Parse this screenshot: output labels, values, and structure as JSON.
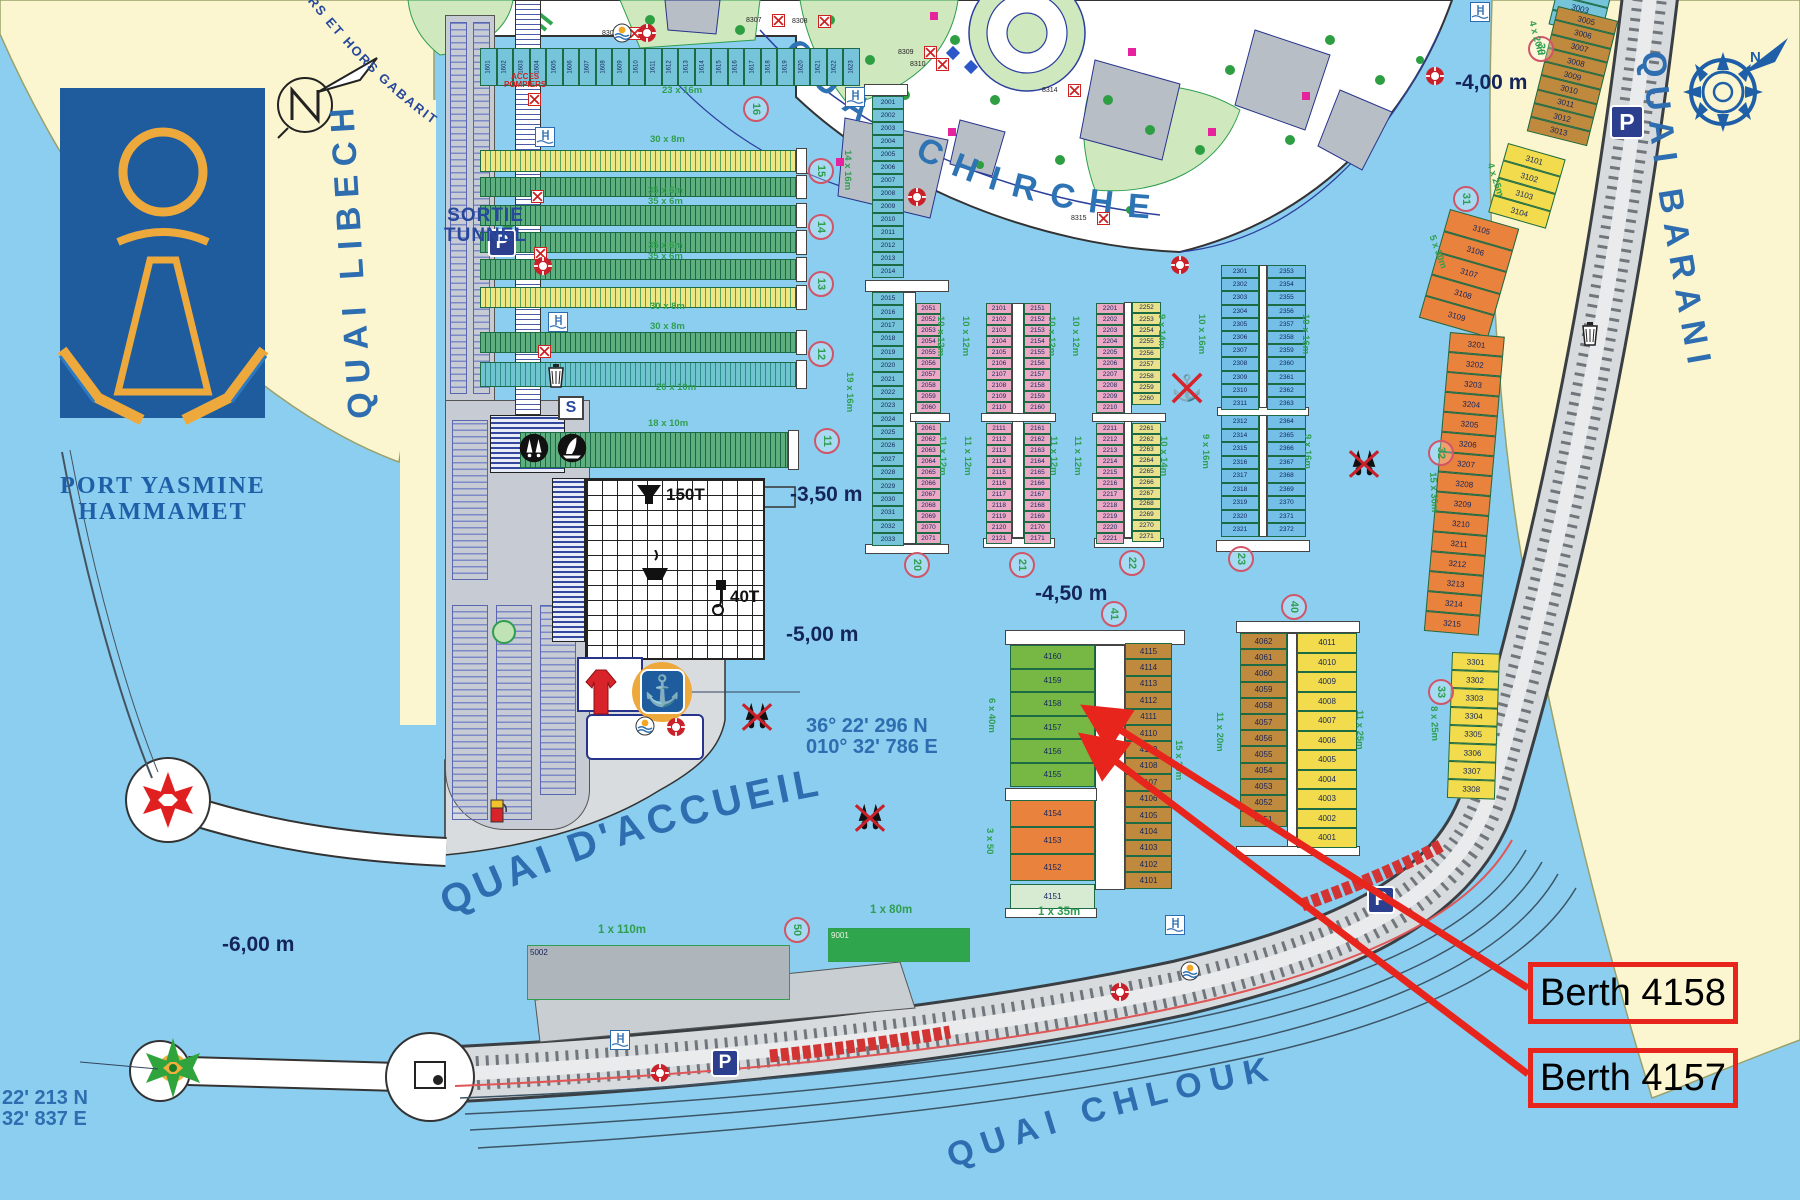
{
  "logo": {
    "title_line1": "PORT YASMINE",
    "title_line2": "HAMMAMET"
  },
  "curved_labels": {
    "top_gabarit": "URS ET HORS GABARIT",
    "quai_libeche": "QUAI LIBECHE",
    "quai_chirche": "QUAI CHIRCHE",
    "quai_barani": "QUAI BARANI",
    "quai_daccueil": "QUAI D'ACCUEIL",
    "quai_chlouk": "QUAI CHLOUK"
  },
  "signs": {
    "sortie_line1": "SORTIE",
    "sortie_line2": "TUNNEL",
    "acces_line1": "ACCES",
    "acces_line2": "POMPIERS",
    "s_sign": "S",
    "lift": "150T",
    "crane": "40T",
    "parking": "P",
    "compass_n": "N"
  },
  "coordinates": {
    "main_line1": "36° 22' 296 N",
    "main_line2": "010° 32' 786 E",
    "west_line1": "22' 213 N",
    "west_line2": "32' 837 E"
  },
  "depth_labels": [
    {
      "text": "-4,00 m",
      "x": 1455,
      "y": 72
    },
    {
      "text": "-3,50 m",
      "x": 790,
      "y": 484
    },
    {
      "text": "-4,50 m",
      "x": 1035,
      "y": 583
    },
    {
      "text": "-5,00 m",
      "x": 786,
      "y": 624
    },
    {
      "text": "-6,00 m",
      "x": 222,
      "y": 934
    }
  ],
  "annotation": {
    "accent": "#E8251C",
    "items": [
      {
        "label": "Berth 4158",
        "box": {
          "x": 1528,
          "y": 962,
          "w": 210,
          "h": 62
        },
        "tip": {
          "x": 1080,
          "y": 706
        }
      },
      {
        "label": "Berth 4157",
        "box": {
          "x": 1528,
          "y": 1048,
          "w": 210,
          "h": 60
        },
        "tip": {
          "x": 1077,
          "y": 735
        }
      }
    ]
  },
  "pontoon_circles": [
    {
      "n": "16",
      "x": 743,
      "y": 96
    },
    {
      "n": "15",
      "x": 808,
      "y": 158
    },
    {
      "n": "14",
      "x": 808,
      "y": 214
    },
    {
      "n": "13",
      "x": 808,
      "y": 271
    },
    {
      "n": "12",
      "x": 808,
      "y": 341
    },
    {
      "n": "11",
      "x": 814,
      "y": 428
    },
    {
      "n": "20",
      "x": 904,
      "y": 552
    },
    {
      "n": "21",
      "x": 1009,
      "y": 552
    },
    {
      "n": "22",
      "x": 1119,
      "y": 550
    },
    {
      "n": "23",
      "x": 1228,
      "y": 546
    },
    {
      "n": "40",
      "x": 1281,
      "y": 594
    },
    {
      "n": "41",
      "x": 1101,
      "y": 601
    },
    {
      "n": "30",
      "x": 1528,
      "y": 36
    },
    {
      "n": "31",
      "x": 1453,
      "y": 186
    },
    {
      "n": "32",
      "x": 1428,
      "y": 440
    },
    {
      "n": "33",
      "x": 1428,
      "y": 679
    },
    {
      "n": "50",
      "x": 784,
      "y": 917
    }
  ],
  "columns": [
    {
      "name": "col-2001",
      "x": 872,
      "y": 96,
      "w": 32,
      "cell_h": 13,
      "count": 14,
      "start": 2001,
      "step": 1,
      "color": "c-teal"
    },
    {
      "name": "col-2015",
      "x": 872,
      "y": 292,
      "w": 32,
      "cell_h": 13.4,
      "count": 19,
      "start": 2015,
      "step": 1,
      "color": "c-teal"
    },
    {
      "name": "col-2051",
      "x": 916,
      "y": 303,
      "w": 25,
      "cell_h": 11,
      "count": 10,
      "start": 2051,
      "step": 1,
      "color": "c-pink"
    },
    {
      "name": "col-2061",
      "x": 916,
      "y": 423,
      "w": 25,
      "cell_h": 11,
      "count": 11,
      "start": 2061,
      "step": 1,
      "color": "c-pink"
    },
    {
      "name": "col-2101",
      "x": 986,
      "y": 303,
      "w": 26,
      "cell_h": 11,
      "count": 10,
      "start": 2101,
      "step": 1,
      "color": "c-pink"
    },
    {
      "name": "col-2111",
      "x": 986,
      "y": 423,
      "w": 26,
      "cell_h": 11,
      "count": 11,
      "start": 2111,
      "step": 1,
      "color": "c-pink"
    },
    {
      "name": "col-2151",
      "x": 1024,
      "y": 303,
      "w": 27,
      "cell_h": 11,
      "count": 10,
      "start": 2151,
      "step": 1,
      "color": "c-pink"
    },
    {
      "name": "col-2161",
      "x": 1024,
      "y": 423,
      "w": 27,
      "cell_h": 11,
      "count": 11,
      "start": 2161,
      "step": 1,
      "color": "c-pink"
    },
    {
      "name": "col-2201",
      "x": 1096,
      "y": 303,
      "w": 28,
      "cell_h": 11,
      "count": 10,
      "start": 2201,
      "step": 1,
      "color": "c-pink"
    },
    {
      "name": "col-2211",
      "x": 1096,
      "y": 423,
      "w": 28,
      "cell_h": 11,
      "count": 11,
      "start": 2211,
      "step": 1,
      "color": "c-pink"
    },
    {
      "name": "col-2252",
      "x": 1132,
      "y": 302,
      "w": 29,
      "cell_h": 11.4,
      "count": 9,
      "start": 2252,
      "step": 1,
      "color": "c-yel"
    },
    {
      "name": "col-2261",
      "x": 1132,
      "y": 423,
      "w": 29,
      "cell_h": 10.8,
      "count": 11,
      "start": 2261,
      "step": 1,
      "color": "c-yel"
    },
    {
      "name": "col-2301",
      "x": 1221,
      "y": 265,
      "w": 38,
      "cell_h": 13.2,
      "count": 11,
      "start": 2301,
      "step": 1,
      "color": "c-blue"
    },
    {
      "name": "col-2312",
      "x": 1221,
      "y": 415,
      "w": 38,
      "cell_h": 13.5,
      "count": 9,
      "nums": [
        2312,
        2314,
        2315,
        2316,
        2317,
        2318,
        2319,
        2320,
        2321
      ],
      "color": "c-blue"
    },
    {
      "name": "col-2353",
      "x": 1267,
      "y": 265,
      "w": 39,
      "cell_h": 13.2,
      "count": 11,
      "start": 2353,
      "step": 1,
      "color": "c-blue"
    },
    {
      "name": "col-2364",
      "x": 1267,
      "y": 415,
      "w": 39,
      "cell_h": 13.5,
      "count": 9,
      "start": 2364,
      "step": 1,
      "color": "c-blue"
    },
    {
      "name": "col-4160",
      "x": 1010,
      "y": 645,
      "w": 85,
      "cell_h": 23.6,
      "count": 6,
      "start": 4160,
      "step": -1,
      "color": "c-green"
    },
    {
      "name": "col-4154",
      "x": 1010,
      "y": 800,
      "w": 85,
      "cell_h": 27,
      "count": 3,
      "start": 4154,
      "step": -1,
      "color": "c-orange"
    },
    {
      "name": "col-4151",
      "x": 1010,
      "y": 884,
      "w": 85,
      "cell_h": 25,
      "count": 1,
      "start": 4151,
      "step": -1,
      "color": "c-lgreen"
    },
    {
      "name": "col-4115",
      "x": 1125,
      "y": 643,
      "w": 47,
      "cell_h": 16.4,
      "count": 15,
      "start": 4115,
      "step": -1,
      "color": "c-tan"
    },
    {
      "name": "col-4062",
      "x": 1240,
      "y": 633,
      "w": 47,
      "cell_h": 16.2,
      "count": 12,
      "start": 4062,
      "step": -1,
      "color": "c-tan"
    },
    {
      "name": "col-4011",
      "x": 1297,
      "y": 633,
      "w": 60,
      "cell_h": 19.5,
      "count": 11,
      "start": 4011,
      "step": -1,
      "color": "c-gold"
    },
    {
      "name": "col-3001",
      "x": 1563,
      "y": -34,
      "w": 54,
      "cell_h": 15,
      "count": 4,
      "start": 3001,
      "step": 1,
      "color": "c-teal",
      "rot": 14
    },
    {
      "name": "col-3005",
      "x": 1558,
      "y": 6,
      "w": 62,
      "cell_h": 14.3,
      "count": 9,
      "start": 3005,
      "step": 1,
      "color": "c-tan",
      "rot": 14
    },
    {
      "name": "col-3101",
      "x": 1508,
      "y": 143,
      "w": 60,
      "cell_h": 18,
      "count": 4,
      "start": 3101,
      "step": 1,
      "color": "c-gold",
      "rot": 16
    },
    {
      "name": "col-3105",
      "x": 1450,
      "y": 209,
      "w": 72,
      "cell_h": 22.5,
      "count": 5,
      "start": 3105,
      "step": 1,
      "color": "c-orange",
      "rot": 16
    },
    {
      "name": "col-3201",
      "x": 1450,
      "y": 332,
      "w": 55,
      "cell_h": 20,
      "count": 15,
      "start": 3201,
      "step": 1,
      "color": "c-orange",
      "rot": 5
    },
    {
      "name": "col-3301",
      "x": 1452,
      "y": 652,
      "w": 48,
      "cell_h": 18.2,
      "count": 8,
      "start": 3301,
      "step": 1,
      "color": "c-gold",
      "rot": 2
    }
  ],
  "row_cells": {
    "name": "row-1601",
    "x": 480,
    "y": 48,
    "w": 380,
    "h": 38,
    "count": 23,
    "start": 1601,
    "color": "c-teal"
  },
  "rows": [
    {
      "name": "row-p15-yellow",
      "x": 480,
      "y": 150,
      "w": 316,
      "h": 22,
      "style": "stripe-yel"
    },
    {
      "name": "row-p15-green",
      "x": 480,
      "y": 177,
      "w": 316,
      "h": 20,
      "style": "stripe-grn"
    },
    {
      "name": "row-p14-green-a",
      "x": 480,
      "y": 205,
      "w": 316,
      "h": 21,
      "style": "stripe-grn"
    },
    {
      "name": "row-p14-green-b",
      "x": 480,
      "y": 232,
      "w": 316,
      "h": 21,
      "style": "stripe-grn"
    },
    {
      "name": "row-p13-green",
      "x": 480,
      "y": 259,
      "w": 316,
      "h": 21,
      "style": "stripe-grn"
    },
    {
      "name": "row-p12-yellow",
      "x": 480,
      "y": 287,
      "w": 316,
      "h": 21,
      "style": "stripe-yel"
    },
    {
      "name": "row-p12-green",
      "x": 480,
      "y": 332,
      "w": 316,
      "h": 21,
      "style": "stripe-grn"
    },
    {
      "name": "row-p11-teal",
      "x": 480,
      "y": 362,
      "w": 316,
      "h": 25,
      "style": "stripe-teal"
    },
    {
      "name": "row-1801-strip",
      "x": 520,
      "y": 432,
      "w": 268,
      "h": 36,
      "style": "stripe-grn"
    }
  ],
  "dim_labels": [
    {
      "text": "23 x 16m",
      "x": 662,
      "y": 86,
      "rot": 0
    },
    {
      "text": "30 x 8m",
      "x": 650,
      "y": 135,
      "rot": 0
    },
    {
      "text": "35 x 6m",
      "x": 648,
      "y": 186,
      "rot": 0
    },
    {
      "text": "35 x 6m",
      "x": 648,
      "y": 197,
      "rot": 0
    },
    {
      "text": "35 x 6m",
      "x": 648,
      "y": 241,
      "rot": 0
    },
    {
      "text": "35 x 6m",
      "x": 648,
      "y": 252,
      "rot": 0
    },
    {
      "text": "30 x 8m",
      "x": 650,
      "y": 302,
      "rot": 0
    },
    {
      "text": "30 x 8m",
      "x": 650,
      "y": 322,
      "rot": 0
    },
    {
      "text": "20 x 10m",
      "x": 656,
      "y": 383,
      "rot": 0
    },
    {
      "text": "18 x 10m",
      "x": 648,
      "y": 419,
      "rot": 0
    },
    {
      "text": "14 x 16m",
      "x": 852,
      "y": 150,
      "rot": 90
    },
    {
      "text": "19 x 16m",
      "x": 854,
      "y": 372,
      "rot": 90
    },
    {
      "text": "10 x 12m",
      "x": 945,
      "y": 316,
      "rot": 90
    },
    {
      "text": "11 x 12m",
      "x": 947,
      "y": 436,
      "rot": 90
    },
    {
      "text": "10 x 12m",
      "x": 970,
      "y": 316,
      "rot": 90
    },
    {
      "text": "11 x 12m",
      "x": 972,
      "y": 436,
      "rot": 90
    },
    {
      "text": "10 x 12m",
      "x": 1056,
      "y": 316,
      "rot": 90
    },
    {
      "text": "11 x 12m",
      "x": 1058,
      "y": 436,
      "rot": 90
    },
    {
      "text": "10 x 12m",
      "x": 1080,
      "y": 316,
      "rot": 90
    },
    {
      "text": "11 x 12m",
      "x": 1082,
      "y": 436,
      "rot": 90
    },
    {
      "text": "9 x 14m",
      "x": 1166,
      "y": 314,
      "rot": 90
    },
    {
      "text": "10 x 14m",
      "x": 1168,
      "y": 436,
      "rot": 90
    },
    {
      "text": "10 x 16m",
      "x": 1206,
      "y": 314,
      "rot": 90
    },
    {
      "text": "9 x 16m",
      "x": 1210,
      "y": 434,
      "rot": 90
    },
    {
      "text": "10 x 16m",
      "x": 1310,
      "y": 314,
      "rot": 90
    },
    {
      "text": "9 x 16m",
      "x": 1312,
      "y": 434,
      "rot": 90
    },
    {
      "text": "6 x 40m",
      "x": 996,
      "y": 698,
      "rot": 90
    },
    {
      "text": "3 x 50",
      "x": 994,
      "y": 828,
      "rot": 90
    },
    {
      "text": "15 x 20m",
      "x": 1183,
      "y": 740,
      "rot": 90
    },
    {
      "text": "11 x 20m",
      "x": 1224,
      "y": 712,
      "rot": 90
    },
    {
      "text": "11 x 25m",
      "x": 1364,
      "y": 710,
      "rot": 90
    },
    {
      "text": "4 x 20m",
      "x": 1536,
      "y": 20,
      "rot": 75
    },
    {
      "text": "4 x 25m",
      "x": 1494,
      "y": 162,
      "rot": 72
    },
    {
      "text": "5 x 30m",
      "x": 1436,
      "y": 234,
      "rot": 70
    },
    {
      "text": "15 x 30m",
      "x": 1437,
      "y": 472,
      "rot": 87
    },
    {
      "text": "8 x 25m",
      "x": 1438,
      "y": 706,
      "rot": 88
    }
  ],
  "size_labels": [
    {
      "text": "1 x 110m",
      "x": 598,
      "y": 924
    },
    {
      "text": "1 x 80m",
      "x": 870,
      "y": 904
    },
    {
      "text": "1 x 35m",
      "x": 1038,
      "y": 906
    }
  ],
  "quay_berths": [
    {
      "num": "5002",
      "x": 527,
      "y": 945,
      "w": 263,
      "h": 55,
      "bg": "#AEB5BB",
      "fg": "#13255C"
    },
    {
      "num": "9001",
      "x": 828,
      "y": 928,
      "w": 142,
      "h": 34,
      "bg": "#2FA64E",
      "fg": "#E8F5E0"
    }
  ],
  "fire_points": [
    {
      "label": "8305",
      "x": 628,
      "y": 27
    },
    {
      "label": "8307",
      "x": 772,
      "y": 14
    },
    {
      "label": "8308",
      "x": 818,
      "y": 15
    },
    {
      "label": "8309",
      "x": 924,
      "y": 46
    },
    {
      "label": "8310",
      "x": 936,
      "y": 58
    },
    {
      "label": "8314",
      "x": 1068,
      "y": 84
    },
    {
      "label": "8315",
      "x": 1097,
      "y": 212
    },
    {
      "label": "",
      "x": 528,
      "y": 93
    },
    {
      "label": "",
      "x": 531,
      "y": 190
    },
    {
      "label": "",
      "x": 534,
      "y": 247
    },
    {
      "label": "",
      "x": 538,
      "y": 345
    }
  ],
  "markers": [
    {
      "type": "parking",
      "x": 502,
      "y": 243,
      "s": 28
    },
    {
      "type": "parking",
      "x": 1627,
      "y": 122,
      "s": 34
    },
    {
      "type": "parking",
      "x": 725,
      "y": 1063,
      "s": 28
    },
    {
      "type": "parking",
      "x": 1381,
      "y": 900,
      "s": 28
    },
    {
      "type": "lifebuoy",
      "x": 647,
      "y": 33
    },
    {
      "type": "lifebuoy",
      "x": 917,
      "y": 197
    },
    {
      "type": "lifebuoy",
      "x": 1180,
      "y": 265
    },
    {
      "type": "lifebuoy",
      "x": 1435,
      "y": 76
    },
    {
      "type": "lifebuoy",
      "x": 543,
      "y": 266
    },
    {
      "type": "lifebuoy",
      "x": 676,
      "y": 727
    },
    {
      "type": "lifebuoy",
      "x": 1120,
      "y": 992
    },
    {
      "type": "lifebuoy",
      "x": 660,
      "y": 1073
    },
    {
      "type": "sun",
      "x": 622,
      "y": 33
    },
    {
      "type": "sun",
      "x": 645,
      "y": 726
    },
    {
      "type": "sun",
      "x": 1190,
      "y": 971
    },
    {
      "type": "shower",
      "x": 545,
      "y": 137
    },
    {
      "type": "shower",
      "x": 558,
      "y": 322
    },
    {
      "type": "shower",
      "x": 855,
      "y": 97
    },
    {
      "type": "shower",
      "x": 620,
      "y": 1040
    },
    {
      "type": "shower",
      "x": 1175,
      "y": 925
    },
    {
      "type": "shower",
      "x": 1480,
      "y": 12
    },
    {
      "type": "fuel",
      "x": 497,
      "y": 808
    },
    {
      "type": "trash",
      "x": 556,
      "y": 374
    },
    {
      "type": "trash",
      "x": 1590,
      "y": 332
    },
    {
      "type": "blackdive",
      "x": 534,
      "y": 448
    },
    {
      "type": "blacksail",
      "x": 572,
      "y": 448
    },
    {
      "type": "noanchor",
      "x": 1187,
      "y": 388
    },
    {
      "type": "noflippers",
      "x": 1364,
      "y": 464
    },
    {
      "type": "noflippers",
      "x": 870,
      "y": 818
    },
    {
      "type": "noflippers",
      "x": 757,
      "y": 717
    }
  ],
  "bars": [
    {
      "x": 864,
      "y": 84,
      "w": 44,
      "h": 12
    },
    {
      "x": 865,
      "y": 280,
      "w": 84,
      "h": 12
    },
    {
      "x": 865,
      "y": 544,
      "w": 84,
      "h": 10
    },
    {
      "x": 903,
      "y": 292,
      "w": 13,
      "h": 252
    },
    {
      "x": 910,
      "y": 413,
      "w": 40,
      "h": 9
    },
    {
      "x": 983,
      "y": 538,
      "w": 72,
      "h": 10
    },
    {
      "x": 1012,
      "y": 303,
      "w": 12,
      "h": 235
    },
    {
      "x": 981,
      "y": 413,
      "w": 75,
      "h": 9
    },
    {
      "x": 1094,
      "y": 538,
      "w": 70,
      "h": 10
    },
    {
      "x": 1124,
      "y": 302,
      "w": 8,
      "h": 236
    },
    {
      "x": 1092,
      "y": 413,
      "w": 74,
      "h": 9
    },
    {
      "x": 1216,
      "y": 540,
      "w": 94,
      "h": 12
    },
    {
      "x": 1259,
      "y": 265,
      "w": 8,
      "h": 272
    },
    {
      "x": 1217,
      "y": 407,
      "w": 92,
      "h": 9
    },
    {
      "x": 1005,
      "y": 630,
      "w": 180,
      "h": 15
    },
    {
      "x": 1095,
      "y": 645,
      "w": 30,
      "h": 245
    },
    {
      "x": 1005,
      "y": 788,
      "w": 92,
      "h": 13
    },
    {
      "x": 1005,
      "y": 908,
      "w": 92,
      "h": 10
    },
    {
      "x": 1236,
      "y": 621,
      "w": 124,
      "h": 12
    },
    {
      "x": 1287,
      "y": 633,
      "w": 10,
      "h": 215
    },
    {
      "x": 1236,
      "y": 846,
      "w": 124,
      "h": 10
    }
  ]
}
